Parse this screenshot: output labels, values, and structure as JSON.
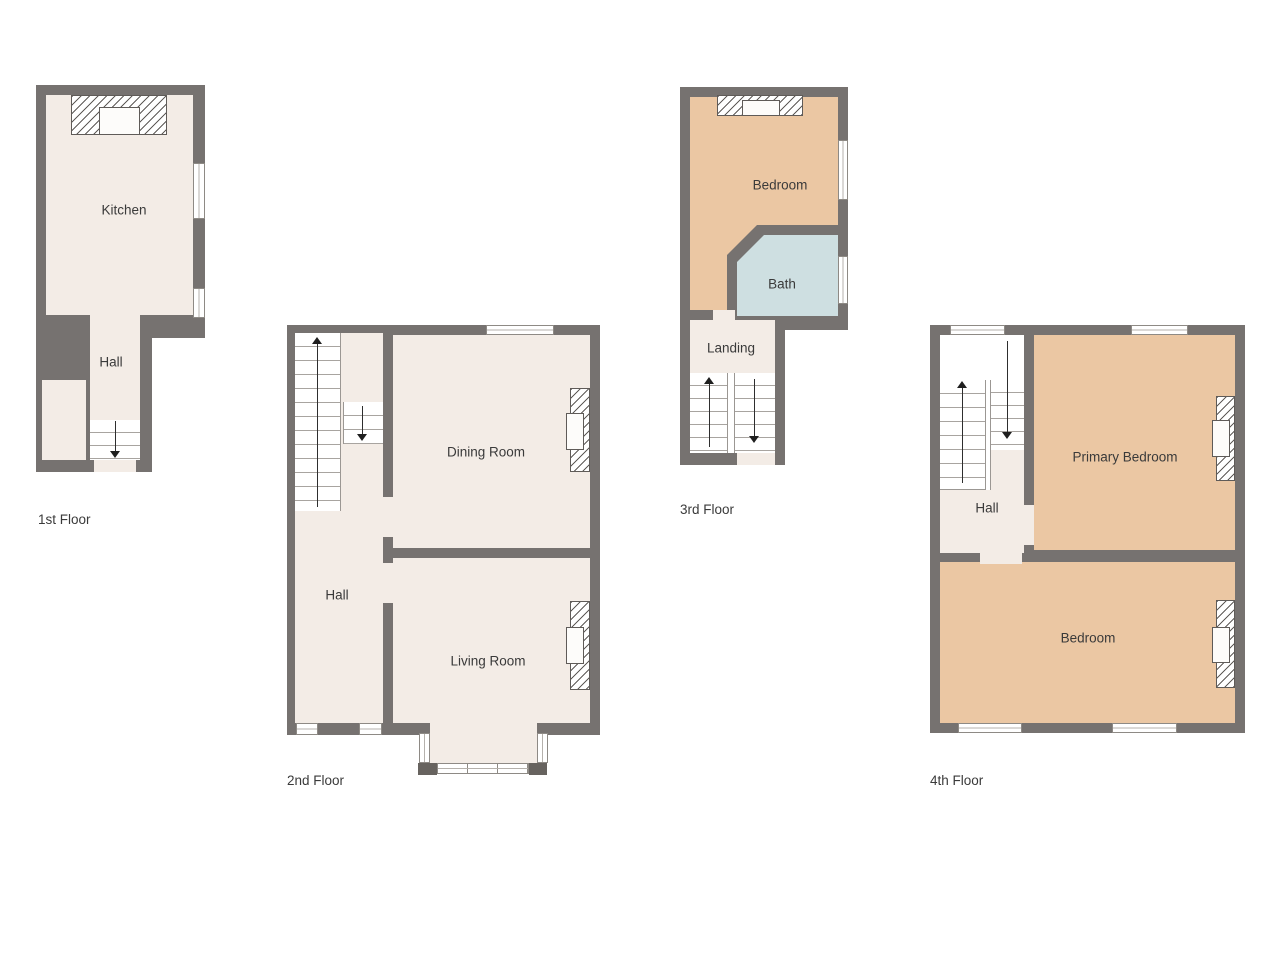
{
  "floors": {
    "f1": {
      "label": "1st Floor",
      "kitchen": "Kitchen",
      "hall": "Hall"
    },
    "f2": {
      "label": "2nd Floor",
      "dining": "Dining Room",
      "hall": "Hall",
      "living": "Living Room"
    },
    "f3": {
      "label": "3rd Floor",
      "bedroom": "Bedroom",
      "bath": "Bath",
      "landing": "Landing"
    },
    "f4": {
      "label": "4th Floor",
      "hall": "Hall",
      "primary": "Primary Bedroom",
      "bedroom": "Bedroom"
    }
  },
  "icons": {
    "stairs_up": "up-arrow",
    "stairs_down": "down-arrow",
    "fireplace": "hatched-chimney-breast",
    "window": "window"
  },
  "colors": {
    "wall": "#767270",
    "floor_cream": "#f3ece6",
    "bedroom_tan": "#ebc7a3",
    "bath_blue": "#cedfe1",
    "stair_white": "#ffffff",
    "bay_post": "#67635f",
    "text": "#3a3a3a"
  }
}
